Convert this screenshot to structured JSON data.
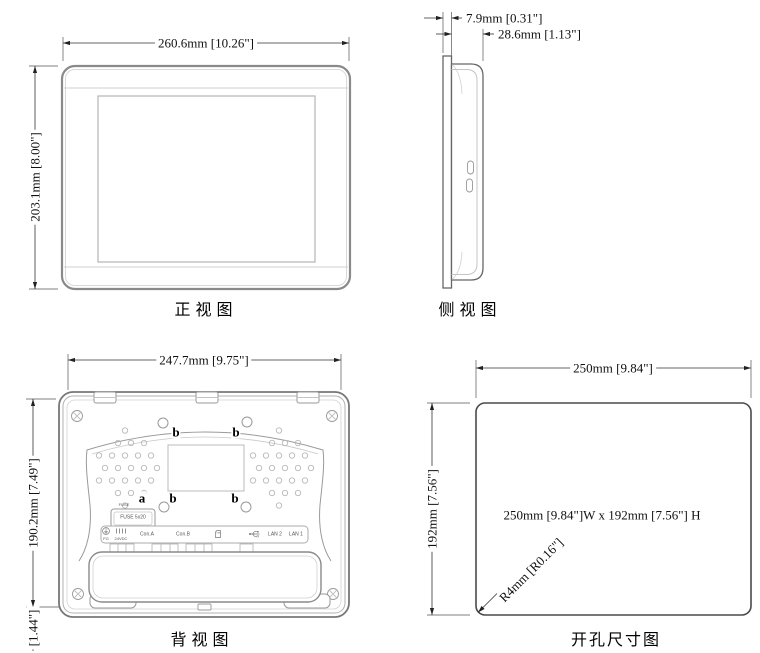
{
  "drawing": {
    "line_color": "#2b2b2b",
    "background": "#ffffff",
    "views": {
      "front": {
        "title": "正视图",
        "width_dim": "260.6mm [10.26\"]",
        "height_dim": "203.1mm [8.00\"]"
      },
      "side": {
        "title": "侧视图",
        "bezel_dim": "7.9mm [0.31\"]",
        "depth_dim": "28.6mm [1.13\"]"
      },
      "back": {
        "title": "背视图",
        "width_dim": "247.7mm [9.75\"]",
        "height_dim": "190.2mm [7.49\"]",
        "bottom_dim": "[1.44\"]",
        "callout_a": "a",
        "callout_b": "b",
        "fuse_small_label": "FUSE",
        "fuse_box_label": "FUSE 5x20",
        "ports": {
          "fg": "FG",
          "power": "24VDC",
          "con_a": "Con.A",
          "con_b": "Con.B",
          "lan2": "LAN 2",
          "lan1": "LAN 1"
        }
      },
      "cutout": {
        "title": "开孔尺寸图",
        "width_dim": "250mm [9.84\"]",
        "height_dim": "192mm [7.56\"]",
        "panel_label": "250mm [9.84\"]W x 192mm [7.56\"] H",
        "radius_label": "R4mm [R0.16\"]"
      }
    }
  }
}
